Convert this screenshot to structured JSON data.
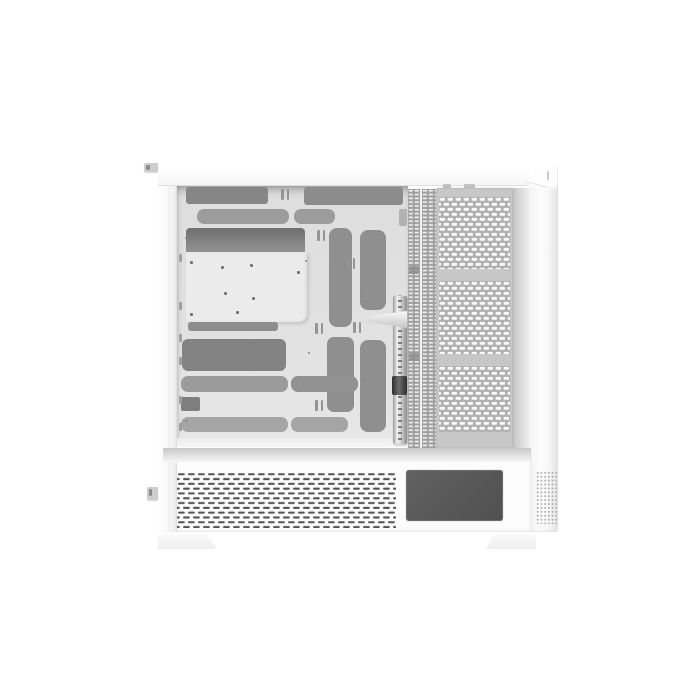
{
  "meta": {
    "description": "Studio product photo of a white dual-chamber mid-tower PC case viewed from the open left side, showing the interior motherboard tray, cable cutouts, GPU support rail, perforated rear mesh and ventilated PSU shroud. No text, labels or UI controls are visible in the image.",
    "background": "#ffffff"
  },
  "colors": {
    "background": "#ffffff",
    "case_white": "#fcfcfc",
    "panel_edge": "#e0e0e0",
    "interior_base": "#dedede",
    "tray_light": "#ebebeb",
    "cutout_dark": "#868686",
    "cutout_mid": "#9c9c9c",
    "cutout_deep": "#6f6f6f",
    "mesh_base": "#b0b0b0",
    "mesh_frame": "#c7c7c7",
    "strip_base": "#a0a0a0",
    "vent_dark": "#555555",
    "window_dark": "#505050",
    "dot_gray": "#a9a9a9",
    "rail_light": "#f3f3f3",
    "rail_dark": "#8f8f8f",
    "knob_dark": "#2e2e2e",
    "tab_gray": "#cdcdcd",
    "shadow_band": "#c8c8c8"
  },
  "parts": {
    "case_body": {
      "label": "White PC case body"
    },
    "top_panel": {
      "label": "Top panel"
    },
    "top_tab": {
      "label": "Front top tab"
    },
    "front_strip": {
      "label": "Front panel edge"
    },
    "interior": {
      "label": "Main chamber interior"
    },
    "motherboard_tray": {
      "label": "Motherboard tray with standoff holes"
    },
    "cable_cutouts": {
      "label": "Cable management cutouts"
    },
    "gpu_rail": {
      "label": "Vertical GPU support rail"
    },
    "gpu_bracket": {
      "label": "GPU anti-sag bracket arm"
    },
    "pci_slot_strips": {
      "label": "Ventilated PCI slot cover strips"
    },
    "mesh_panel": {
      "label": "Perforated side exhaust mesh panel"
    },
    "rear_band": {
      "label": "Rear panel edge"
    },
    "psu_shroud": {
      "label": "Power supply shroud"
    },
    "shroud_vents": {
      "label": "Shroud ventilation slots"
    },
    "shroud_window": {
      "label": "Shroud side window"
    },
    "rear_dots": {
      "label": "Rear perforated vent"
    },
    "shroud_tab": {
      "label": "Side panel release tab"
    },
    "foot_left": {
      "label": "Left case foot"
    },
    "foot_right": {
      "label": "Right case foot"
    }
  }
}
